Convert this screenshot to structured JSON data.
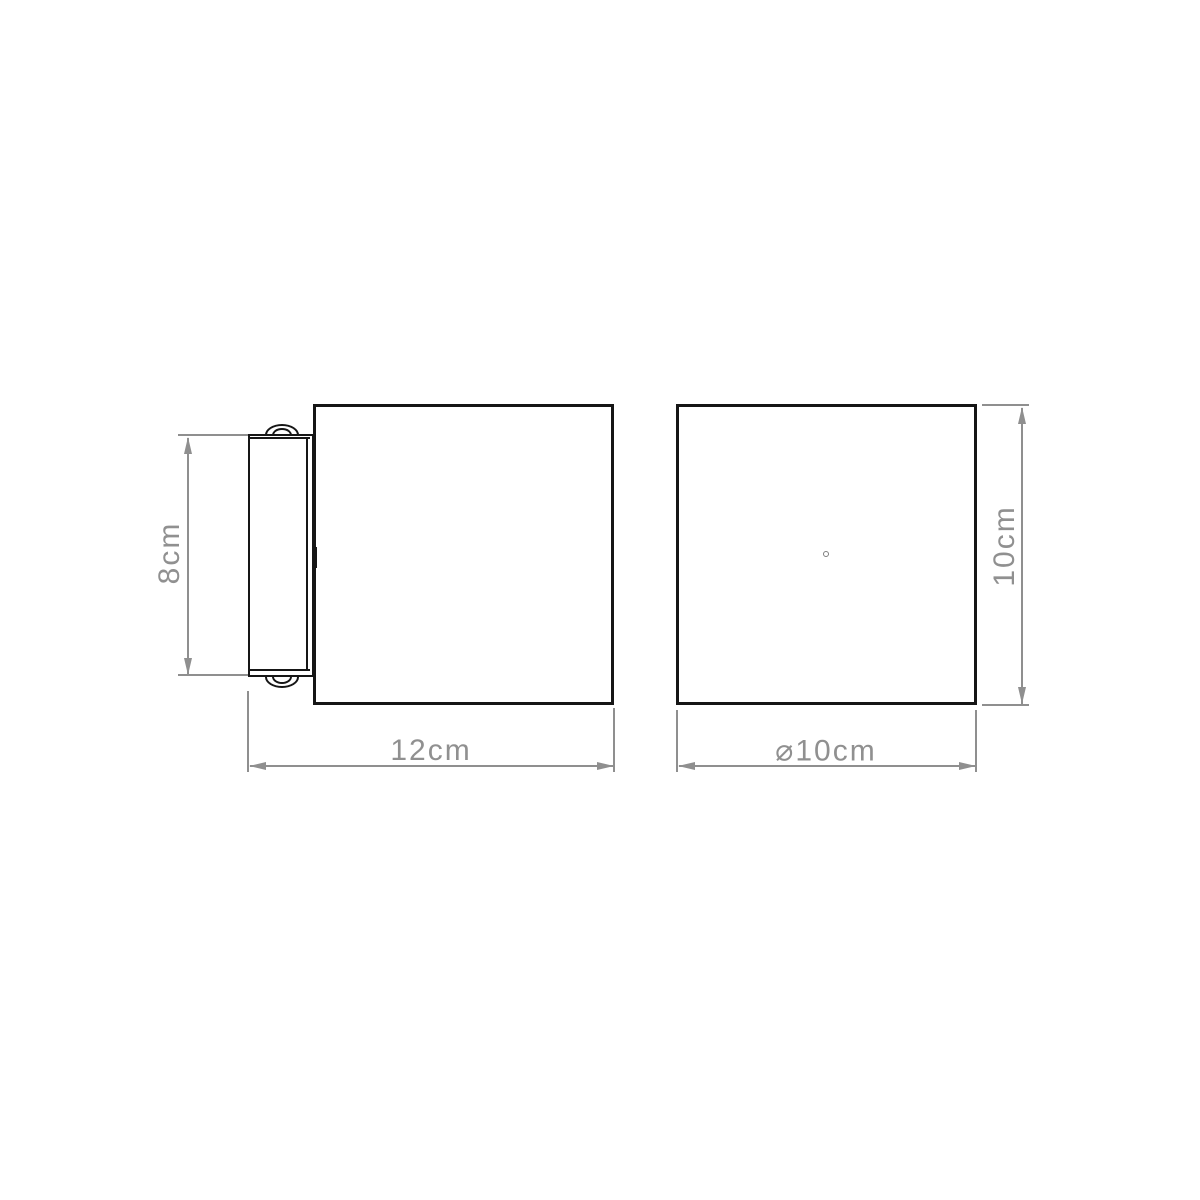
{
  "canvas": {
    "width": 1200,
    "height": 1200,
    "background": "#ffffff"
  },
  "style": {
    "object_line_color": "#161616",
    "dimension_line_color": "#8f8f8f",
    "dimension_text_color": "#909090"
  },
  "drawing": {
    "type": "technical-dimension-drawing",
    "views": {
      "side": {
        "name": "side-elevation",
        "dimensions": {
          "height": {
            "label": "8cm",
            "value": 8,
            "unit": "cm"
          },
          "depth": {
            "label": "12cm",
            "value": 12,
            "unit": "cm"
          }
        }
      },
      "front": {
        "name": "front-elevation",
        "dimensions": {
          "height": {
            "label": "10cm",
            "value": 10,
            "unit": "cm"
          },
          "diameter": {
            "label": "⌀10cm",
            "value": 10,
            "unit": "cm"
          }
        }
      }
    }
  }
}
